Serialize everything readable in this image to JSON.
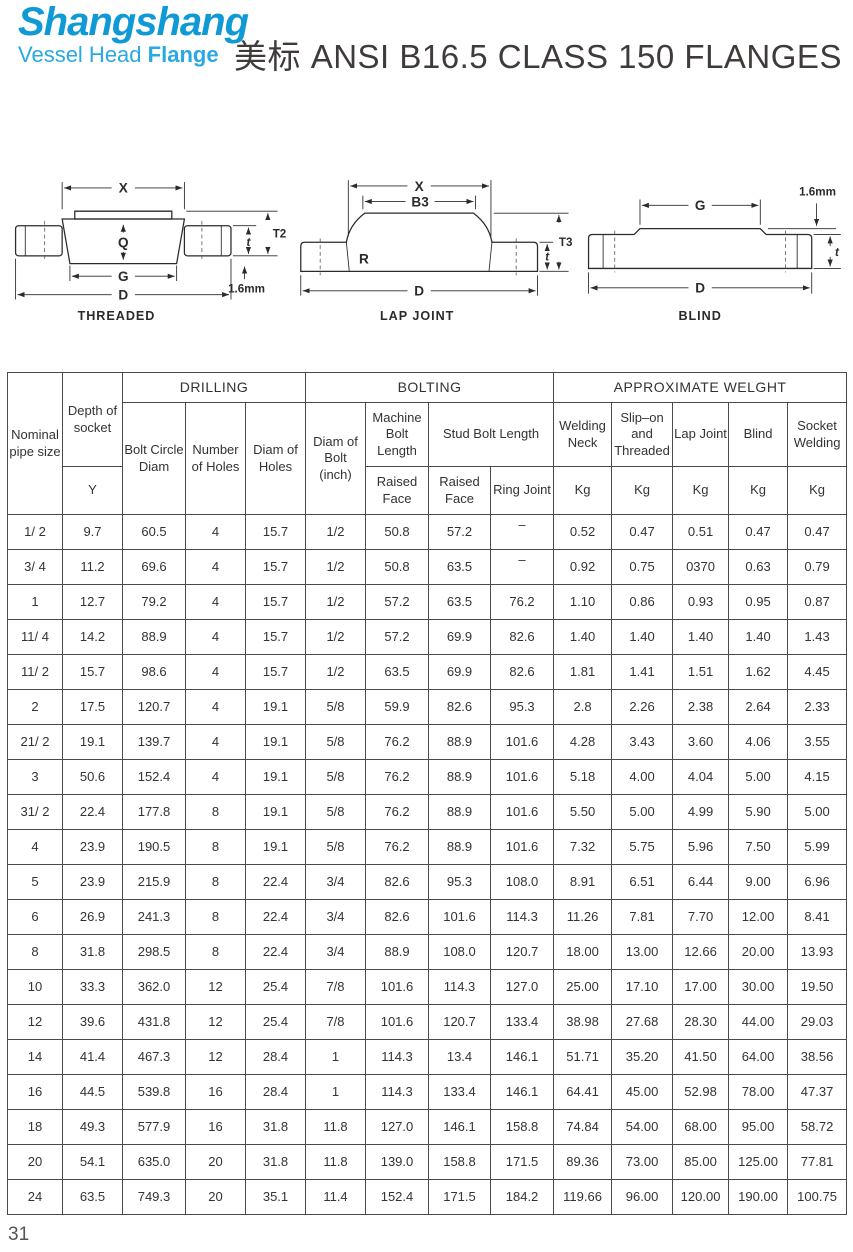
{
  "colors": {
    "logo_primary": "#0f9ad6",
    "logo_secondary": "#29a9e1",
    "title_text": "#403b3b",
    "table_line": "#4a4a4a",
    "drawing_line": "#2b2b2b"
  },
  "logo": {
    "title": "Shangshang",
    "subtitle_light": "Vessel Head",
    "subtitle_bold": "Flange"
  },
  "page_title": "美标 ANSI B16.5 CLASS 150 FLANGES",
  "page_number": "31",
  "drawings": {
    "threaded": {
      "caption": "THREADED",
      "dim_x": "X",
      "dim_q": "Q",
      "dim_g": "G",
      "dim_d": "D",
      "dim_t": "t",
      "dim_t2": "T2",
      "dim_gap": "1.6mm"
    },
    "lap_joint": {
      "caption": "LAP JOINT",
      "dim_x": "X",
      "dim_b3": "B3",
      "dim_r": "R",
      "dim_d": "D",
      "dim_t": "t",
      "dim_t3": "T3"
    },
    "blind": {
      "caption": "BLIND",
      "dim_g": "G",
      "dim_d": "D",
      "dim_t": "t",
      "dim_gap": "1.6mm"
    }
  },
  "table": {
    "header": {
      "nominal_pipe_size": "Nominal pipe size",
      "depth_of_socket": "Depth of socket",
      "depth_symbol": "Y",
      "drilling": "DRILLING",
      "bolting": "BOLTING",
      "approx_weight": "APPROXIMATE WELGHT",
      "bolt_circle_diam": "Bolt Circle Diam",
      "number_of_holes": "Number of Holes",
      "diam_of_holes": "Diam of Holes",
      "diam_of_bolt": "Diam of Bolt (inch)",
      "machine_bolt_length": "Machine Bolt Length",
      "stud_bolt_length": "Stud Bolt Length",
      "raised_face": "Raised Face",
      "ring_joint": "Ring Joint",
      "welding_neck": "Welding Neck",
      "slip_on_threaded": "Slip–on and Threaded",
      "lap_joint": "Lap Joint",
      "blind": "Blind",
      "socket_welding": "Socket Welding",
      "kg": "Kg"
    },
    "rows": [
      [
        "1/ 2",
        "9.7",
        "60.5",
        "4",
        "15.7",
        "1/2",
        "50.8",
        "57.2",
        "–",
        "0.52",
        "0.47",
        "0.51",
        "0.47",
        "0.47"
      ],
      [
        "3/ 4",
        "11.2",
        "69.6",
        "4",
        "15.7",
        "1/2",
        "50.8",
        "63.5",
        "–",
        "0.92",
        "0.75",
        "0370",
        "0.63",
        "0.79"
      ],
      [
        "1",
        "12.7",
        "79.2",
        "4",
        "15.7",
        "1/2",
        "57.2",
        "63.5",
        "76.2",
        "1.10",
        "0.86",
        "0.93",
        "0.95",
        "0.87"
      ],
      [
        "11/ 4",
        "14.2",
        "88.9",
        "4",
        "15.7",
        "1/2",
        "57.2",
        "69.9",
        "82.6",
        "1.40",
        "1.40",
        "1.40",
        "1.40",
        "1.43"
      ],
      [
        "11/ 2",
        "15.7",
        "98.6",
        "4",
        "15.7",
        "1/2",
        "63.5",
        "69.9",
        "82.6",
        "1.81",
        "1.41",
        "1.51",
        "1.62",
        "4.45"
      ],
      [
        "2",
        "17.5",
        "120.7",
        "4",
        "19.1",
        "5/8",
        "59.9",
        "82.6",
        "95.3",
        "2.8",
        "2.26",
        "2.38",
        "2.64",
        "2.33"
      ],
      [
        "21/ 2",
        "19.1",
        "139.7",
        "4",
        "19.1",
        "5/8",
        "76.2",
        "88.9",
        "101.6",
        "4.28",
        "3.43",
        "3.60",
        "4.06",
        "3.55"
      ],
      [
        "3",
        "50.6",
        "152.4",
        "4",
        "19.1",
        "5/8",
        "76.2",
        "88.9",
        "101.6",
        "5.18",
        "4.00",
        "4.04",
        "5.00",
        "4.15"
      ],
      [
        "31/ 2",
        "22.4",
        "177.8",
        "8",
        "19.1",
        "5/8",
        "76.2",
        "88.9",
        "101.6",
        "5.50",
        "5.00",
        "4.99",
        "5.90",
        "5.00"
      ],
      [
        "4",
        "23.9",
        "190.5",
        "8",
        "19.1",
        "5/8",
        "76.2",
        "88.9",
        "101.6",
        "7.32",
        "5.75",
        "5.96",
        "7.50",
        "5.99"
      ],
      [
        "5",
        "23.9",
        "215.9",
        "8",
        "22.4",
        "3/4",
        "82.6",
        "95.3",
        "108.0",
        "8.91",
        "6.51",
        "6.44",
        "9.00",
        "6.96"
      ],
      [
        "6",
        "26.9",
        "241.3",
        "8",
        "22.4",
        "3/4",
        "82.6",
        "101.6",
        "114.3",
        "11.26",
        "7.81",
        "7.70",
        "12.00",
        "8.41"
      ],
      [
        "8",
        "31.8",
        "298.5",
        "8",
        "22.4",
        "3/4",
        "88.9",
        "108.0",
        "120.7",
        "18.00",
        "13.00",
        "12.66",
        "20.00",
        "13.93"
      ],
      [
        "10",
        "33.3",
        "362.0",
        "12",
        "25.4",
        "7/8",
        "101.6",
        "114.3",
        "127.0",
        "25.00",
        "17.10",
        "17.00",
        "30.00",
        "19.50"
      ],
      [
        "12",
        "39.6",
        "431.8",
        "12",
        "25.4",
        "7/8",
        "101.6",
        "120.7",
        "133.4",
        "38.98",
        "27.68",
        "28.30",
        "44.00",
        "29.03"
      ],
      [
        "14",
        "41.4",
        "467.3",
        "12",
        "28.4",
        "1",
        "114.3",
        "13.4",
        "146.1",
        "51.71",
        "35.20",
        "41.50",
        "64.00",
        "38.56"
      ],
      [
        "16",
        "44.5",
        "539.8",
        "16",
        "28.4",
        "1",
        "114.3",
        "133.4",
        "146.1",
        "64.41",
        "45.00",
        "52.98",
        "78.00",
        "47.37"
      ],
      [
        "18",
        "49.3",
        "577.9",
        "16",
        "31.8",
        "11.8",
        "127.0",
        "146.1",
        "158.8",
        "74.84",
        "54.00",
        "68.00",
        "95.00",
        "58.72"
      ],
      [
        "20",
        "54.1",
        "635.0",
        "20",
        "31.8",
        "11.8",
        "139.0",
        "158.8",
        "171.5",
        "89.36",
        "73.00",
        "85.00",
        "125.00",
        "77.81"
      ],
      [
        "24",
        "63.5",
        "749.3",
        "20",
        "35.1",
        "11.4",
        "152.4",
        "171.5",
        "184.2",
        "119.66",
        "96.00",
        "120.00",
        "190.00",
        "100.75"
      ]
    ]
  }
}
